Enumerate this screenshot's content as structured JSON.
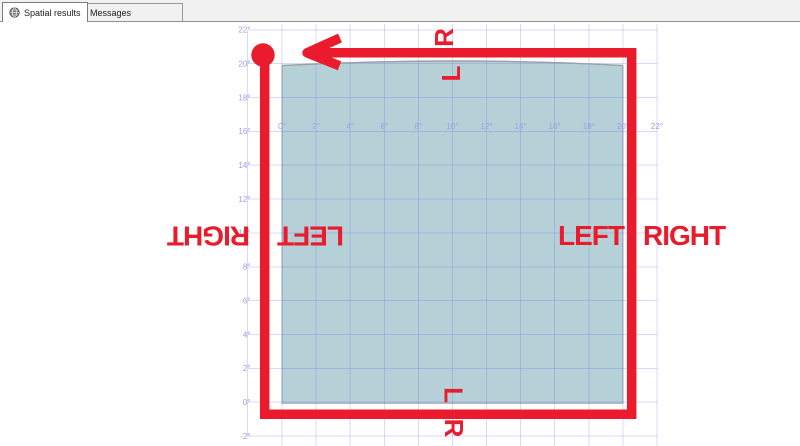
{
  "tabs": [
    {
      "label": "Spatial results",
      "icon": "globe-icon",
      "active": true
    },
    {
      "label": "Messages",
      "icon": "messages-icon",
      "active": false
    }
  ],
  "plot": {
    "x_axis": {
      "tick_labels": [
        "0°",
        "2°",
        "4°",
        "6°",
        "8°",
        "10°",
        "12°",
        "14°",
        "16°",
        "18°",
        "20°",
        "22°"
      ],
      "tick_values": [
        0,
        2,
        4,
        6,
        8,
        10,
        12,
        14,
        16,
        18,
        20,
        22
      ]
    },
    "y_axis": {
      "tick_labels": [
        "22°",
        "20°",
        "18°",
        "16°",
        "14°",
        "12°",
        "10°",
        "8°",
        "6°",
        "4°",
        "2°",
        "0°",
        "-2°"
      ],
      "tick_values": [
        22,
        20,
        18,
        16,
        14,
        12,
        10,
        8,
        6,
        4,
        2,
        0,
        -2
      ]
    }
  },
  "annotations": {
    "right_inside": "LEFT",
    "right_outside": "RIGHT",
    "left_outside_rotated": "RIGHT",
    "left_inside_rotated": "LEFT",
    "direction_l": "L",
    "direction_r": "R"
  },
  "colors": {
    "annotation_red": "#ea1b2c",
    "polygon_fill": "#b5d1d7",
    "polygon_top_stroke": "#9aa2a6",
    "grid_line": "#6e6ee4",
    "axis_label": "#9c9ce8"
  },
  "chart_data": {
    "type": "spatial-grid",
    "x_axis_ticks_deg": [
      0,
      2,
      4,
      6,
      8,
      10,
      12,
      14,
      16,
      18,
      20,
      22
    ],
    "y_axis_ticks_deg": [
      22,
      20,
      18,
      16,
      14,
      12,
      10,
      8,
      6,
      4,
      2,
      0,
      -2
    ],
    "polygon_extent_deg": {
      "x": [
        0,
        20
      ],
      "y": [
        0,
        20
      ]
    },
    "polygon_note": "teal filled square from 0° to 20° in both axes; top edge is a slight upward geodesic arc",
    "red_ring_note": "thick red ring drawn just outside the polygon; start marker circle at top-left corner; arrow on top edge points left; LEFT/RIGHT written across right edge, rotated 180° across left edge, rotated L/R across top and bottom edges"
  }
}
